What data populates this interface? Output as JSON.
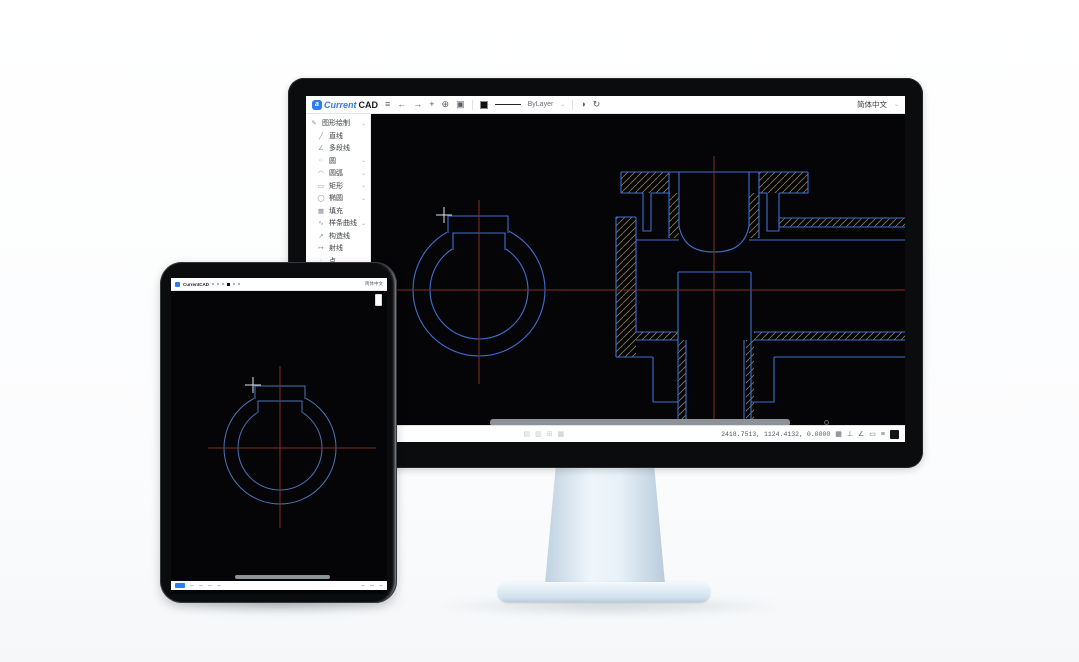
{
  "brand": {
    "badge_letter": "a",
    "name_primary": "Current",
    "name_secondary": "CAD"
  },
  "top_toolbar": {
    "icons": [
      {
        "name": "menu",
        "glyph": "≡"
      },
      {
        "name": "undo",
        "glyph": "←"
      },
      {
        "name": "redo",
        "glyph": "→"
      },
      {
        "name": "add",
        "glyph": "+"
      },
      {
        "name": "magnifier",
        "glyph": "⊕"
      },
      {
        "name": "panel",
        "glyph": "▣"
      }
    ],
    "color_swatch": "#111111",
    "linetype_label": "ByLayer",
    "dropdown_chevron": "⌄",
    "right_icons": [
      {
        "name": "history",
        "glyph": "◑"
      },
      {
        "name": "refresh",
        "glyph": "↻"
      }
    ],
    "language": "简体中文",
    "language_chevron": "⌄"
  },
  "sidebar": {
    "items": [
      {
        "label": "图形绘制",
        "glyph": "✎",
        "chevron": "⌄"
      },
      {
        "label": "直线",
        "glyph": "╱",
        "chevron": ""
      },
      {
        "label": "多段线",
        "glyph": "∠",
        "chevron": ""
      },
      {
        "label": "圆",
        "glyph": "○",
        "chevron": "⌄"
      },
      {
        "label": "圆弧",
        "glyph": "◠",
        "chevron": "⌄"
      },
      {
        "label": "矩形",
        "glyph": "▭",
        "chevron": "⌄"
      },
      {
        "label": "椭圆",
        "glyph": "◯",
        "chevron": "⌄"
      },
      {
        "label": "填充",
        "glyph": "▦",
        "chevron": ""
      },
      {
        "label": "样条曲线",
        "glyph": "∿",
        "chevron": "⌄"
      },
      {
        "label": "构造线",
        "glyph": "↗",
        "chevron": ""
      },
      {
        "label": "射线",
        "glyph": "↦",
        "chevron": ""
      },
      {
        "label": "点",
        "glyph": "∙",
        "chevron": ""
      },
      {
        "label": "图案填充",
        "glyph": "▨",
        "chevron": "⌄"
      }
    ]
  },
  "floating_toolbar": {
    "icons": [
      {
        "name": "select",
        "glyph": "↖"
      },
      {
        "name": "pan",
        "glyph": "⊞"
      },
      {
        "name": "zoom",
        "glyph": "⊕"
      },
      {
        "name": "home",
        "glyph": "⌂"
      },
      {
        "name": "layers",
        "glyph": "▤"
      }
    ]
  },
  "status_bar": {
    "tabs": [
      "模型",
      "布局1"
    ],
    "center_icons": [
      "▤",
      "▥",
      "⊞",
      "▦"
    ],
    "coordinates": "2418.7513, 1124.4132, 0.0000",
    "right_icons": [
      {
        "name": "grid",
        "glyph": "▦"
      },
      {
        "name": "ortho",
        "glyph": "⊥"
      },
      {
        "name": "polar",
        "glyph": "∠"
      },
      {
        "name": "osnap",
        "glyph": "▭"
      },
      {
        "name": "lineweight",
        "glyph": "≡"
      }
    ]
  },
  "tablet": {
    "logo": "CurrentCAD",
    "language": "简体中文"
  },
  "colors": {
    "accent_blue": "#2f7bf5",
    "cad_line": "#3f6fcf",
    "hatch": "#8f7c50",
    "centerline": "#7e2e2e",
    "canvas": "#050507"
  }
}
